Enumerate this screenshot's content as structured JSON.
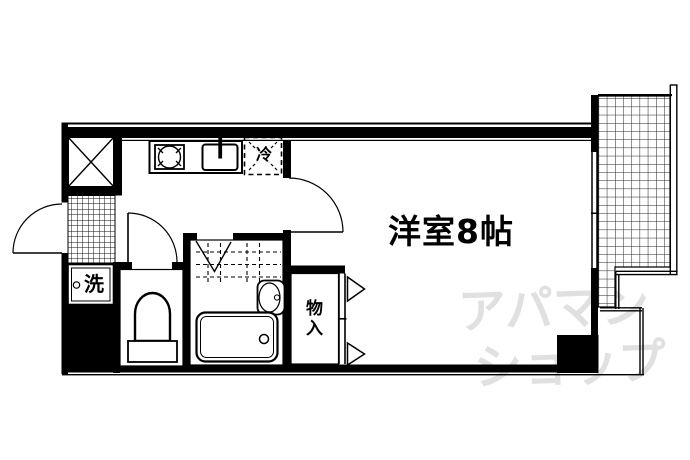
{
  "floorplan": {
    "room_label": "洋室8帖",
    "fridge_label": "冷",
    "washer_label": "洗",
    "closet_label": "物入",
    "watermark_line1": "アパマン",
    "watermark_line2": "ショップ",
    "colors": {
      "wall": "#000000",
      "background": "#ffffff",
      "watermark": "#e0e0e0"
    }
  }
}
